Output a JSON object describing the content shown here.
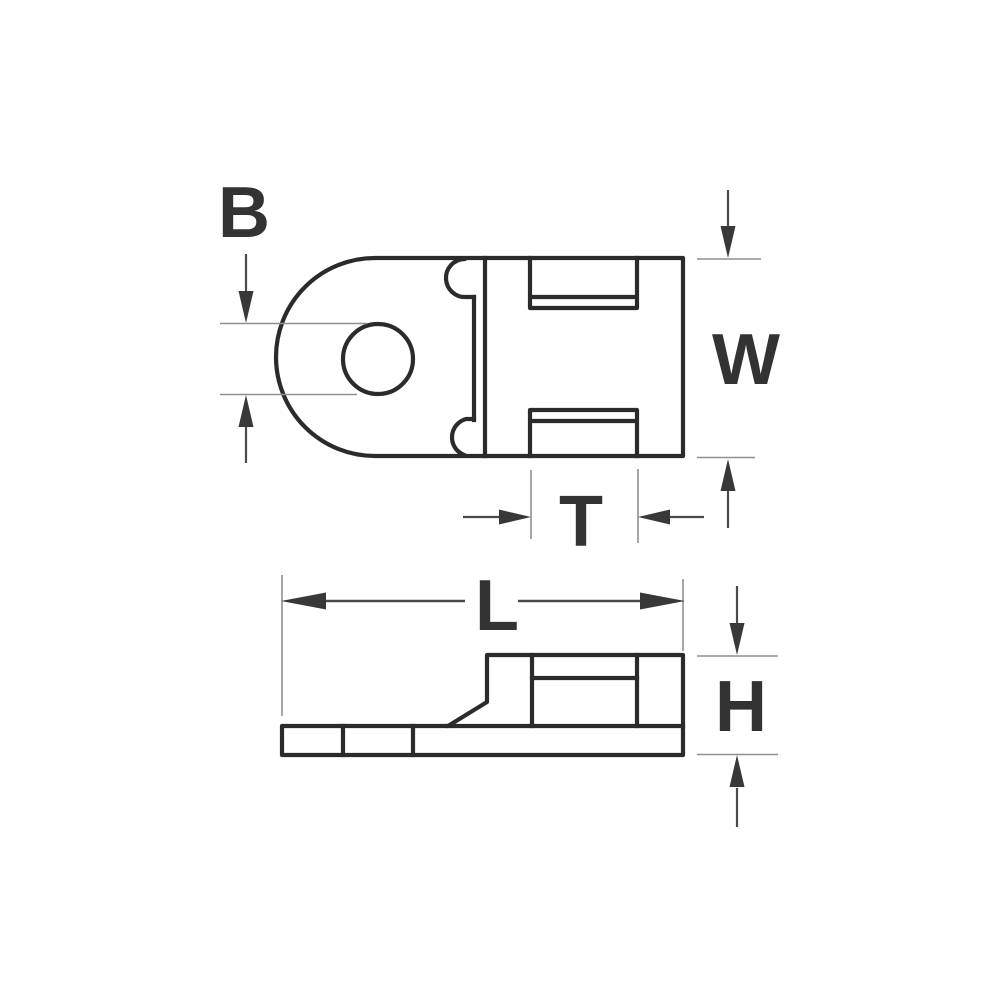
{
  "diagram": {
    "dimensions": {
      "hole_diameter": "B",
      "body_width": "W",
      "slot_width": "T",
      "overall_length": "L",
      "overall_height": "H"
    },
    "colors": {
      "outline": "#2b2b2b",
      "dimension_line": "#4a4a4a",
      "arrowhead": "#383838",
      "extension_line": "#8f8f8f",
      "label": "#333333",
      "background": "#ffffff"
    }
  }
}
